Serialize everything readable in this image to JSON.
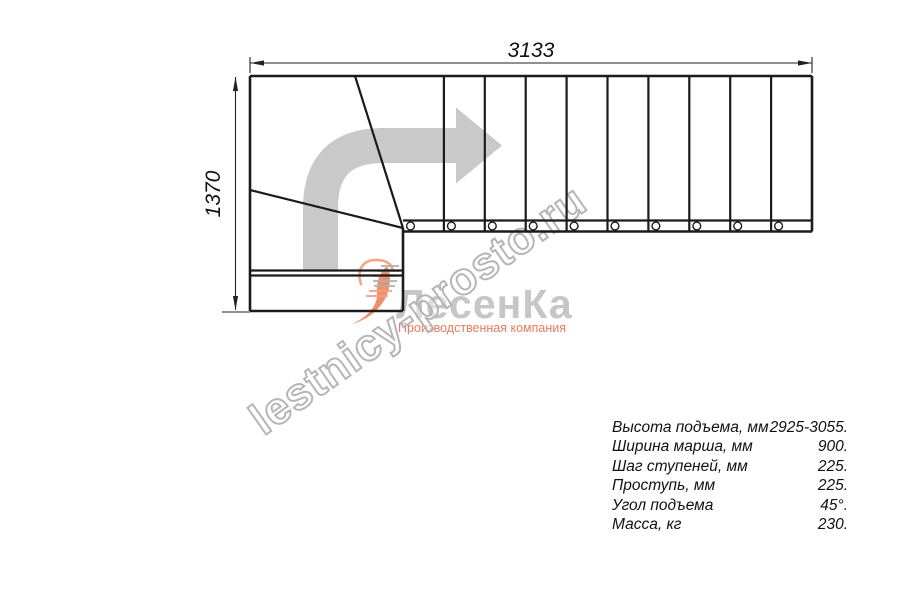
{
  "drawing": {
    "width_dim": "3133",
    "height_dim": "1370",
    "straight_step_count": 10,
    "baluster_count": 10,
    "line_color": "#1b1b1b",
    "arrow_color": "#c9c9c9"
  },
  "watermark": {
    "text": "lestnicy-prosto.ru",
    "stroke_color": "#b3b3b3"
  },
  "logo": {
    "name": "ЛесенКа",
    "tagline": "Производственная компания",
    "name_color": "#c6c6c6",
    "tagline_color": "#e87a60",
    "swoosh_color": "#f0906a"
  },
  "specs": {
    "rows": [
      {
        "label": "Высота подъема, мм",
        "value": "2925-3055."
      },
      {
        "label": "Ширина марша, мм",
        "value": "900."
      },
      {
        "label": "Шаг ступеней, мм",
        "value": "225."
      },
      {
        "label": "Проступь, мм",
        "value": "225."
      },
      {
        "label": "Угол подъема",
        "value": "45°."
      },
      {
        "label": "Масса, кг",
        "value": "230."
      }
    ]
  }
}
